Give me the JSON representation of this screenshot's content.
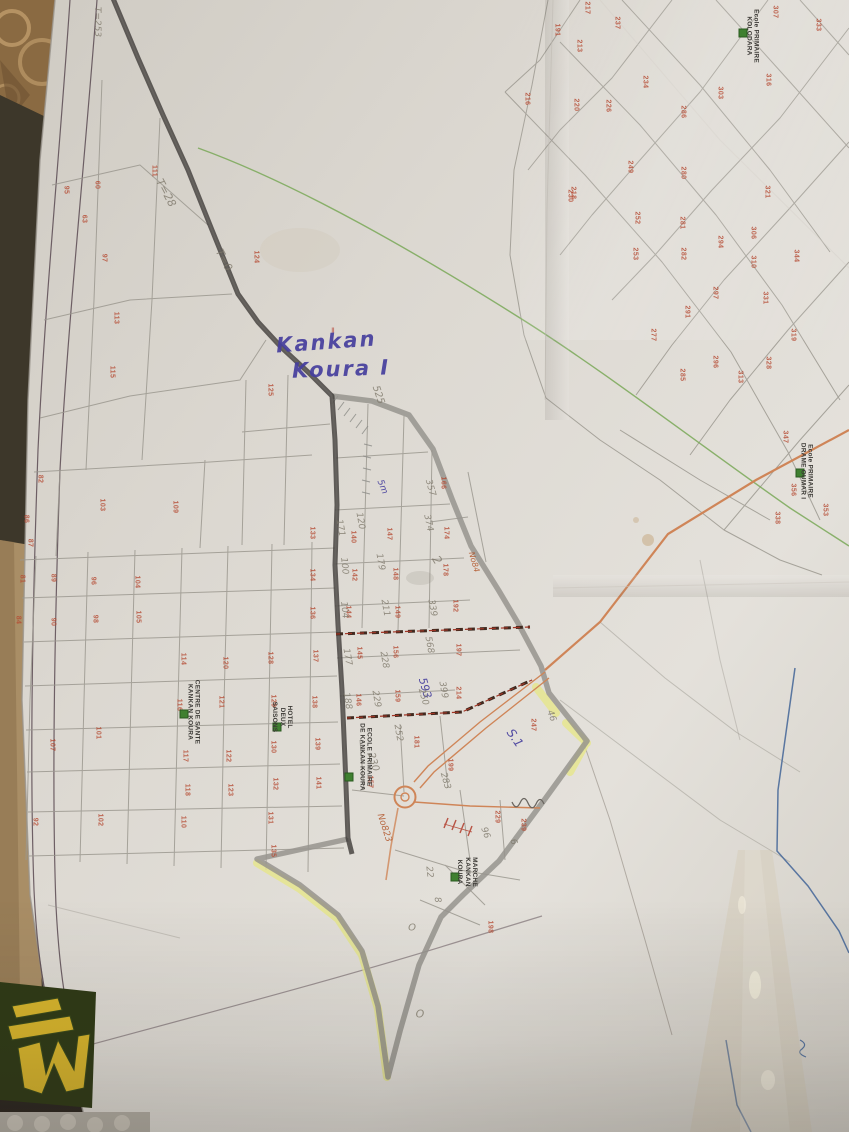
{
  "handwriting": {
    "sector_line1": "Kankan",
    "sector_line2": "Koura I"
  },
  "colors": {
    "paper": "#dcd8d1",
    "red": "#b54a32",
    "pencil": "#7d7769",
    "blue_ink": "#463f9e",
    "orange_ink": "#b05226",
    "road_orange": "#cf8558",
    "line_green": "#79a857",
    "line_blue": "#4a6a9a",
    "boundary_dark": "#3f3b38",
    "boundary_gray": "#97948e",
    "highlight_yellow": "#e6e68a",
    "poi_green": "#3f8030",
    "frame": "#5a4a52",
    "parcel": "#9b988f",
    "logo_yellow": "#d8b52c",
    "logo_green": "#2f3a16",
    "wood": "#a98e66",
    "carpet": "#8a6a42",
    "floor": "#2c2620"
  },
  "pois": [
    {
      "id": "centre-de-sante",
      "lines": [
        "CENTRE DE SANTE",
        "KANKAN KOURA"
      ],
      "x": 193,
      "y": 712,
      "sqx": 184,
      "sqy": 714
    },
    {
      "id": "hotel-deux-saisons",
      "lines": [
        "HOTEL",
        "DEUX",
        "SAISONS"
      ],
      "x": 282,
      "y": 717,
      "sqx": 277,
      "sqy": 727
    },
    {
      "id": "ecole-primaire-kankan-koura",
      "lines": [
        "ECOLE PRIMAIRE",
        "DE KANKAN KOURA"
      ],
      "x": 365,
      "y": 757,
      "sqx": 349,
      "sqy": 777
    },
    {
      "id": "marche-kankan-koura",
      "lines": [
        "MARCHE",
        "KANKAN",
        "KOURA"
      ],
      "x": 467,
      "y": 872,
      "sqx": 455,
      "sqy": 877
    },
    {
      "id": "ecole-primaire-drame-oumar",
      "lines": [
        "Ecole PRIMAIRE",
        "DRAME OUMAR I"
      ],
      "x": 806,
      "y": 471,
      "sqx": 800,
      "sqy": 473
    },
    {
      "id": "ecole-primaire-kolodara",
      "lines": [
        "Ecole PRIMAIRE",
        "KOLODARA"
      ],
      "x": 752,
      "y": 36,
      "sqx": 743,
      "sqy": 33
    }
  ],
  "plots": [
    {
      "n": "95",
      "x": 66,
      "y": 190
    },
    {
      "n": "97",
      "x": 104,
      "y": 258
    },
    {
      "n": "111",
      "x": 154,
      "y": 171
    },
    {
      "n": "124",
      "x": 256,
      "y": 257
    },
    {
      "n": "113",
      "x": 116,
      "y": 318
    },
    {
      "n": "115",
      "x": 112,
      "y": 372
    },
    {
      "n": "125",
      "x": 270,
      "y": 390
    },
    {
      "n": "230",
      "x": 570,
      "y": 196
    },
    {
      "n": "217",
      "x": 587,
      "y": 8
    },
    {
      "n": "237",
      "x": 617,
      "y": 23
    },
    {
      "n": "191",
      "x": 557,
      "y": 30
    },
    {
      "n": "213",
      "x": 579,
      "y": 46
    },
    {
      "n": "216",
      "x": 527,
      "y": 99
    },
    {
      "n": "220",
      "x": 576,
      "y": 105
    },
    {
      "n": "226",
      "x": 608,
      "y": 106
    },
    {
      "n": "234",
      "x": 645,
      "y": 82
    },
    {
      "n": "286",
      "x": 683,
      "y": 112
    },
    {
      "n": "249",
      "x": 630,
      "y": 167
    },
    {
      "n": "280",
      "x": 683,
      "y": 173
    },
    {
      "n": "218",
      "x": 573,
      "y": 193
    },
    {
      "n": "252",
      "x": 637,
      "y": 218
    },
    {
      "n": "281",
      "x": 682,
      "y": 223
    },
    {
      "n": "253",
      "x": 635,
      "y": 254
    },
    {
      "n": "282",
      "x": 683,
      "y": 254
    },
    {
      "n": "294",
      "x": 720,
      "y": 242
    },
    {
      "n": "306",
      "x": 753,
      "y": 233
    },
    {
      "n": "310",
      "x": 753,
      "y": 262
    },
    {
      "n": "321",
      "x": 767,
      "y": 192
    },
    {
      "n": "344",
      "x": 796,
      "y": 256
    },
    {
      "n": "297",
      "x": 715,
      "y": 293
    },
    {
      "n": "331",
      "x": 765,
      "y": 298
    },
    {
      "n": "291",
      "x": 687,
      "y": 312
    },
    {
      "n": "277",
      "x": 653,
      "y": 335
    },
    {
      "n": "285",
      "x": 682,
      "y": 375
    },
    {
      "n": "296",
      "x": 715,
      "y": 362
    },
    {
      "n": "313",
      "x": 740,
      "y": 377
    },
    {
      "n": "328",
      "x": 768,
      "y": 363
    },
    {
      "n": "319",
      "x": 793,
      "y": 335
    },
    {
      "n": "307",
      "x": 775,
      "y": 12
    },
    {
      "n": "333",
      "x": 818,
      "y": 25
    },
    {
      "n": "316",
      "x": 768,
      "y": 80
    },
    {
      "n": "303",
      "x": 720,
      "y": 93
    },
    {
      "n": "347",
      "x": 785,
      "y": 437
    },
    {
      "n": "356",
      "x": 793,
      "y": 490
    },
    {
      "n": "353",
      "x": 825,
      "y": 510
    },
    {
      "n": "338",
      "x": 777,
      "y": 518
    },
    {
      "n": "60",
      "x": 97,
      "y": 185
    },
    {
      "n": "63",
      "x": 84,
      "y": 219
    },
    {
      "n": "82",
      "x": 40,
      "y": 479
    },
    {
      "n": "103",
      "x": 102,
      "y": 505
    },
    {
      "n": "109",
      "x": 175,
      "y": 507
    },
    {
      "n": "86",
      "x": 26,
      "y": 519
    },
    {
      "n": "87",
      "x": 30,
      "y": 543
    },
    {
      "n": "81",
      "x": 22,
      "y": 579
    },
    {
      "n": "89",
      "x": 53,
      "y": 578
    },
    {
      "n": "96",
      "x": 93,
      "y": 581
    },
    {
      "n": "104",
      "x": 137,
      "y": 582
    },
    {
      "n": "84",
      "x": 18,
      "y": 620
    },
    {
      "n": "90",
      "x": 53,
      "y": 622
    },
    {
      "n": "98",
      "x": 95,
      "y": 619
    },
    {
      "n": "105",
      "x": 138,
      "y": 617
    },
    {
      "n": "114",
      "x": 183,
      "y": 659
    },
    {
      "n": "120",
      "x": 225,
      "y": 663
    },
    {
      "n": "128",
      "x": 270,
      "y": 658
    },
    {
      "n": "137",
      "x": 315,
      "y": 656
    },
    {
      "n": "145",
      "x": 359,
      "y": 653
    },
    {
      "n": "156",
      "x": 395,
      "y": 652
    },
    {
      "n": "121",
      "x": 221,
      "y": 702
    },
    {
      "n": "129",
      "x": 273,
      "y": 701
    },
    {
      "n": "138",
      "x": 314,
      "y": 702
    },
    {
      "n": "146",
      "x": 358,
      "y": 700
    },
    {
      "n": "159",
      "x": 397,
      "y": 696
    },
    {
      "n": "117",
      "x": 185,
      "y": 756
    },
    {
      "n": "122",
      "x": 228,
      "y": 756
    },
    {
      "n": "130",
      "x": 273,
      "y": 747
    },
    {
      "n": "139",
      "x": 317,
      "y": 744
    },
    {
      "n": "141",
      "x": 318,
      "y": 783
    },
    {
      "n": "132",
      "x": 275,
      "y": 784
    },
    {
      "n": "157",
      "x": 370,
      "y": 782
    },
    {
      "n": "116",
      "x": 179,
      "y": 705
    },
    {
      "n": "133",
      "x": 312,
      "y": 533
    },
    {
      "n": "134",
      "x": 312,
      "y": 575
    },
    {
      "n": "136",
      "x": 312,
      "y": 613
    },
    {
      "n": "140",
      "x": 353,
      "y": 537
    },
    {
      "n": "147",
      "x": 389,
      "y": 534
    },
    {
      "n": "142",
      "x": 354,
      "y": 575
    },
    {
      "n": "148",
      "x": 395,
      "y": 574
    },
    {
      "n": "144",
      "x": 348,
      "y": 612
    },
    {
      "n": "149",
      "x": 397,
      "y": 612
    },
    {
      "n": "166",
      "x": 443,
      "y": 483
    },
    {
      "n": "174",
      "x": 446,
      "y": 533
    },
    {
      "n": "178",
      "x": 445,
      "y": 570
    },
    {
      "n": "192",
      "x": 455,
      "y": 606
    },
    {
      "n": "197",
      "x": 458,
      "y": 650
    },
    {
      "n": "214",
      "x": 458,
      "y": 693
    },
    {
      "n": "247",
      "x": 533,
      "y": 725
    },
    {
      "n": "181",
      "x": 416,
      "y": 742
    },
    {
      "n": "199",
      "x": 450,
      "y": 765
    },
    {
      "n": "229",
      "x": 497,
      "y": 817
    },
    {
      "n": "239",
      "x": 523,
      "y": 825
    },
    {
      "n": "198",
      "x": 490,
      "y": 927
    },
    {
      "n": "101",
      "x": 98,
      "y": 733
    },
    {
      "n": "102",
      "x": 100,
      "y": 820
    },
    {
      "n": "110",
      "x": 183,
      "y": 822
    },
    {
      "n": "118",
      "x": 187,
      "y": 790
    },
    {
      "n": "123",
      "x": 230,
      "y": 790
    },
    {
      "n": "131",
      "x": 270,
      "y": 818
    },
    {
      "n": "135",
      "x": 273,
      "y": 851
    },
    {
      "n": "92",
      "x": 35,
      "y": 822
    },
    {
      "n": "107",
      "x": 52,
      "y": 745
    }
  ],
  "annotations": [
    {
      "t": "T=253",
      "x": 97,
      "y": 22,
      "c": "pencil",
      "r": 90,
      "s": 9
    },
    {
      "t": "T=28",
      "x": 166,
      "y": 193,
      "c": "pencil",
      "r": 62,
      "s": 11
    },
    {
      "t": "T=0",
      "x": 224,
      "y": 260,
      "c": "pencil",
      "r": 62,
      "s": 11
    },
    {
      "t": "525",
      "x": 378,
      "y": 395,
      "c": "pencil",
      "r": 72,
      "s": 10
    },
    {
      "t": "5m",
      "x": 382,
      "y": 487,
      "c": "blue",
      "r": 68,
      "s": 9
    },
    {
      "t": "357",
      "x": 430,
      "y": 488,
      "c": "pencil",
      "r": 74,
      "s": 9
    },
    {
      "t": "374",
      "x": 428,
      "y": 523,
      "c": "pencil",
      "r": 78,
      "s": 9
    },
    {
      "t": "171",
      "x": 340,
      "y": 528,
      "c": "pencil",
      "r": 80,
      "s": 9
    },
    {
      "t": "120",
      "x": 360,
      "y": 521,
      "c": "pencil",
      "r": 80,
      "s": 9
    },
    {
      "t": "100",
      "x": 344,
      "y": 566,
      "c": "pencil",
      "r": 84,
      "s": 9
    },
    {
      "t": "179",
      "x": 380,
      "y": 562,
      "c": "pencil",
      "r": 80,
      "s": 9
    },
    {
      "t": "2",
      "x": 437,
      "y": 560,
      "c": "pencil",
      "r": 58,
      "s": 12
    },
    {
      "t": "No84",
      "x": 474,
      "y": 562,
      "c": "orange",
      "r": 74,
      "s": 8
    },
    {
      "t": "104",
      "x": 344,
      "y": 610,
      "c": "pencil",
      "r": 84,
      "s": 9
    },
    {
      "t": "211",
      "x": 385,
      "y": 608,
      "c": "pencil",
      "r": 80,
      "s": 9
    },
    {
      "t": "339",
      "x": 432,
      "y": 608,
      "c": "pencil",
      "r": 80,
      "s": 9
    },
    {
      "t": "568",
      "x": 429,
      "y": 645,
      "c": "pencil",
      "r": 80,
      "s": 9
    },
    {
      "t": "177",
      "x": 347,
      "y": 657,
      "c": "pencil",
      "r": 80,
      "s": 9
    },
    {
      "t": "228",
      "x": 384,
      "y": 660,
      "c": "pencil",
      "r": 80,
      "s": 9
    },
    {
      "t": "188",
      "x": 347,
      "y": 701,
      "c": "pencil",
      "r": 80,
      "s": 9
    },
    {
      "t": "229",
      "x": 376,
      "y": 699,
      "c": "pencil",
      "r": 80,
      "s": 9
    },
    {
      "t": "399",
      "x": 443,
      "y": 690,
      "c": "pencil",
      "r": 80,
      "s": 9
    },
    {
      "t": "593",
      "x": 425,
      "y": 688,
      "c": "blue",
      "r": 74,
      "s": 11
    },
    {
      "t": "S.1",
      "x": 515,
      "y": 738,
      "c": "blue",
      "r": 55,
      "s": 12
    },
    {
      "t": "46",
      "x": 551,
      "y": 716,
      "c": "pencil",
      "r": 70,
      "s": 9
    },
    {
      "t": "250",
      "x": 423,
      "y": 697,
      "c": "pencil",
      "r": 74,
      "s": 9
    },
    {
      "t": "252",
      "x": 398,
      "y": 733,
      "c": "pencil",
      "r": 80,
      "s": 9
    },
    {
      "t": "230",
      "x": 373,
      "y": 762,
      "c": "pencil",
      "r": 74,
      "s": 10
    },
    {
      "t": "283",
      "x": 445,
      "y": 781,
      "c": "pencil",
      "r": 74,
      "s": 9
    },
    {
      "t": "No823",
      "x": 384,
      "y": 828,
      "c": "orange",
      "r": 72,
      "s": 9
    },
    {
      "t": "96",
      "x": 485,
      "y": 833,
      "c": "pencil",
      "r": 70,
      "s": 9
    },
    {
      "t": "6",
      "x": 513,
      "y": 842,
      "c": "pencil",
      "r": 70,
      "s": 9
    },
    {
      "t": "22",
      "x": 429,
      "y": 872,
      "c": "pencil",
      "r": 84,
      "s": 9
    },
    {
      "t": "8",
      "x": 437,
      "y": 900,
      "c": "pencil",
      "r": 80,
      "s": 9
    },
    {
      "t": "O",
      "x": 412,
      "y": 928,
      "c": "pencil",
      "r": 0,
      "s": 10
    },
    {
      "t": "O",
      "x": 420,
      "y": 1014,
      "c": "pencil",
      "r": 0,
      "s": 11
    },
    {
      "t": "=",
      "x": 333,
      "y": 330,
      "c": "red",
      "r": 90,
      "s": 8
    }
  ]
}
